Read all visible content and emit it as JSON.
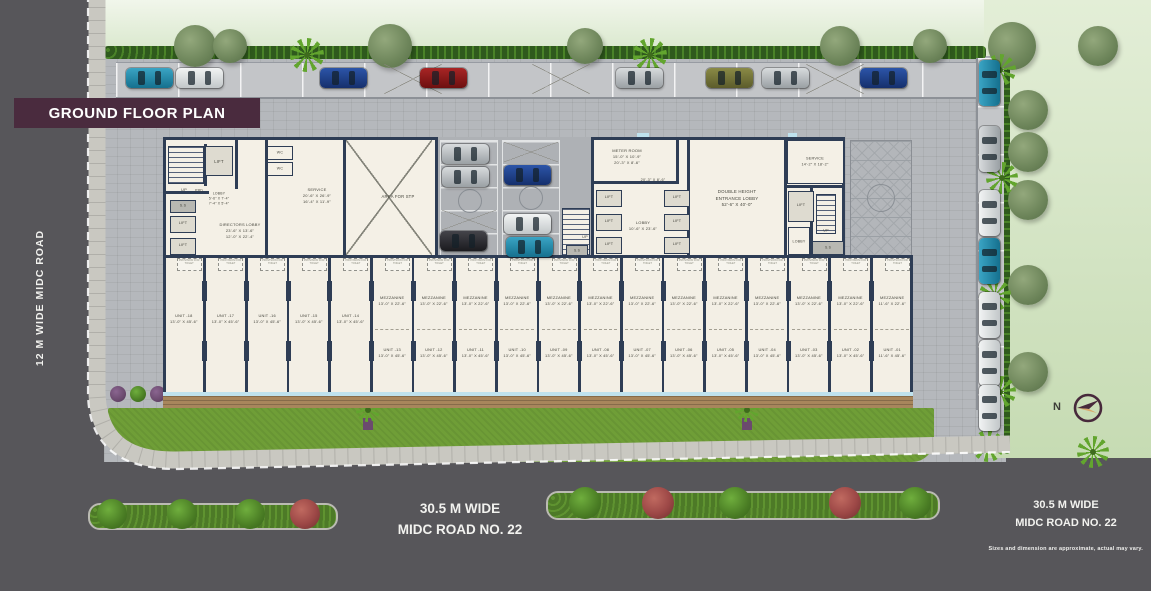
{
  "title": "GROUND FLOOR PLAN",
  "roads": {
    "left": "12 M WIDE MIDC ROAD",
    "bottom_line1": "30.5 M WIDE",
    "bottom_line2": "MIDC ROAD NO. 22",
    "right_line1": "30.5 M WIDE",
    "right_line2": "MIDC ROAD NO. 22"
  },
  "disclaimer": "Sizes and dimension are approximate, actual may vary.",
  "compass": {
    "north_label": "N"
  },
  "plan": {
    "rooms": {
      "up1": [
        "UP"
      ],
      "lift_tl": [
        "LIFT"
      ],
      "prd": [
        "PRD"
      ],
      "lobby_tl": [
        "LOBBY",
        "5'-6\" X 7'-4\"",
        "7'-4\" X 5'-4\""
      ],
      "ss1": [
        "S.S"
      ],
      "lift_l1": [
        "LIFT"
      ],
      "lift_l2": [
        "LIFT"
      ],
      "directors": [
        "DIRECTORS LOBBY",
        "23'-6\" X 13'-6\"",
        "12'-0\" X 22'-4\""
      ],
      "wc1": [
        "WC"
      ],
      "wc2": [
        "WC"
      ],
      "service_l": [
        "SERVICE",
        "20'-6\" X 26'-9\"",
        "16'-4\" X 11'-9\""
      ],
      "stp": [
        "AREA FOR STP"
      ],
      "up2": [
        "UP"
      ],
      "ss2": [
        "S.S"
      ],
      "meter": [
        "METER ROOM",
        "15'-0\" X 10'-9\"",
        "20'-3\" X 8'-6\""
      ],
      "corridor_dim": [
        "20'-3\" X 8'-6\""
      ],
      "lift1": [
        "LIFT"
      ],
      "lift2": [
        "LIFT"
      ],
      "lift3": [
        "LIFT"
      ],
      "lift4": [
        "LIFT"
      ],
      "lift5": [
        "LIFT"
      ],
      "lift6": [
        "LIFT"
      ],
      "lobby_m": [
        "LOBBY",
        "10'-6\" X 23'-6\""
      ],
      "dh": [
        "DOUBLE HEIGHT",
        "ENTRANCE LOBBY",
        "52'-6\" X 40'-0\""
      ],
      "service_r": [
        "SERVICE",
        "14'-2\" X 18'-2\""
      ],
      "lift_r": [
        "LIFT"
      ],
      "up3": [
        "UP"
      ],
      "lobby_r": [
        "LOBBY"
      ],
      "ss3": [
        "S.S"
      ]
    },
    "mezzanine_label": "MEZZANINE",
    "provision_label": "PROVISION FOR TOILET",
    "units": [
      {
        "no": "UNIT -18",
        "dim": "13'-0\" X 45'-6\""
      },
      {
        "no": "UNIT -17",
        "dim": "13'-0\" X 45'-6\""
      },
      {
        "no": "UNIT -16",
        "dim": "13'-0\" X 45'-6\""
      },
      {
        "no": "UNIT -15",
        "dim": "13'-0\" X 45'-6\""
      },
      {
        "no": "UNIT -14",
        "dim": "13'-0\" X 45'-6\""
      },
      {
        "no": "UNIT -13",
        "dim": "13'-0\" X 45'-6\"",
        "mezz_dim": "13'-0\" X 22'-6\""
      },
      {
        "no": "UNIT -12",
        "dim": "13'-0\" X 45'-6\"",
        "mezz_dim": "13'-0\" X 22'-6\""
      },
      {
        "no": "UNIT -11",
        "dim": "13'-0\" X 45'-6\"",
        "mezz_dim": "13'-0\" X 22'-6\""
      },
      {
        "no": "UNIT -10",
        "dim": "13'-0\" X 45'-6\"",
        "mezz_dim": "13'-0\" X 22'-6\""
      },
      {
        "no": "UNIT -09",
        "dim": "13'-0\" X 45'-6\"",
        "mezz_dim": "13'-0\" X 22'-6\""
      },
      {
        "no": "UNIT -08",
        "dim": "13'-0\" X 45'-6\"",
        "mezz_dim": "13'-0\" X 22'-6\""
      },
      {
        "no": "UNIT -07",
        "dim": "13'-0\" X 45'-6\"",
        "mezz_dim": "13'-0\" X 22'-6\""
      },
      {
        "no": "UNIT -06",
        "dim": "13'-0\" X 45'-6\"",
        "mezz_dim": "13'-0\" X 22'-6\""
      },
      {
        "no": "UNIT -05",
        "dim": "13'-0\" X 45'-6\"",
        "mezz_dim": "13'-0\" X 22'-6\""
      },
      {
        "no": "UNIT -04",
        "dim": "13'-0\" X 45'-6\"",
        "mezz_dim": "13'-0\" X 22'-6\""
      },
      {
        "no": "UNIT -03",
        "dim": "13'-0\" X 45'-6\"",
        "mezz_dim": "13'-0\" X 22'-6\""
      },
      {
        "no": "UNIT -02",
        "dim": "13'-0\" X 45'-6\"",
        "mezz_dim": "13'-0\" X 22'-6\""
      },
      {
        "no": "UNIT -01",
        "dim": "11'-6\" X 45'-6\"",
        "mezz_dim": "11'-6\" X 22'-6\""
      }
    ]
  },
  "scene": {
    "colors": {
      "title_bg": "#4a2b3e",
      "wall": "#2e3d55",
      "road": "#57565a",
      "lawn": "#6f9e37",
      "room_fill": "#f4f0e6",
      "glass": "#bfe2ee"
    },
    "top_cars": [
      {
        "x": 126,
        "c": "teal"
      },
      {
        "x": 176,
        "c": "white"
      },
      {
        "x": 320,
        "c": "navy"
      },
      {
        "x": 420,
        "c": "red"
      },
      {
        "x": 616,
        "c": "silver"
      },
      {
        "x": 706,
        "c": "olive"
      },
      {
        "x": 762,
        "c": "silver"
      },
      {
        "x": 860,
        "c": "navy"
      }
    ],
    "bay_cars": [
      {
        "x": 442,
        "y": 144,
        "c": "silver"
      },
      {
        "x": 442,
        "y": 167,
        "c": "silver"
      },
      {
        "x": 440,
        "y": 231,
        "c": "black"
      },
      {
        "x": 504,
        "y": 165,
        "c": "navy"
      },
      {
        "x": 504,
        "y": 214,
        "c": "white"
      },
      {
        "x": 506,
        "y": 237,
        "c": "teal"
      }
    ],
    "right_cars": [
      {
        "y": 60,
        "c": "teal"
      },
      {
        "y": 126,
        "c": "silver"
      },
      {
        "y": 190,
        "c": "white"
      },
      {
        "y": 238,
        "c": "teal"
      },
      {
        "y": 292,
        "c": "white"
      },
      {
        "y": 340,
        "c": "white"
      },
      {
        "y": 385,
        "c": "white"
      }
    ],
    "top_trees": [
      {
        "x": 195,
        "r": 21
      },
      {
        "x": 230,
        "r": 17
      },
      {
        "x": 390,
        "r": 22
      },
      {
        "x": 585,
        "r": 18
      },
      {
        "x": 840,
        "r": 20
      },
      {
        "x": 930,
        "r": 17
      },
      {
        "x": 1012,
        "r": 24
      },
      {
        "x": 1098,
        "r": 20
      }
    ],
    "top_palms": [
      {
        "x": 307
      },
      {
        "x": 650
      }
    ],
    "right_trees": [
      {
        "y": 110
      },
      {
        "y": 152
      },
      {
        "y": 200
      },
      {
        "y": 285
      },
      {
        "y": 372
      }
    ],
    "right_palms": [
      {
        "x": 1000,
        "y": 70
      },
      {
        "x": 1002,
        "y": 178
      },
      {
        "x": 995,
        "y": 295
      },
      {
        "x": 1000,
        "y": 392
      },
      {
        "x": 988,
        "y": 446
      },
      {
        "x": 1093,
        "y": 452
      }
    ],
    "lawn_palms": [
      {
        "x": 368
      },
      {
        "x": 747
      }
    ],
    "lawn_shrubs": [
      {
        "x": 118,
        "c": "purple"
      },
      {
        "x": 138,
        "c": "green"
      },
      {
        "x": 158,
        "c": "purple"
      },
      {
        "x": 178,
        "c": "green"
      },
      {
        "x": 200,
        "c": "purple"
      },
      {
        "x": 222,
        "c": "green"
      }
    ],
    "median1_shrubs": [
      {
        "x": 112,
        "c": "green"
      },
      {
        "x": 182,
        "c": "green"
      },
      {
        "x": 250,
        "c": "green"
      },
      {
        "x": 305,
        "c": "red"
      }
    ],
    "median2_shrubs": [
      {
        "x": 585,
        "c": "green"
      },
      {
        "x": 658,
        "c": "red"
      },
      {
        "x": 735,
        "c": "green"
      },
      {
        "x": 845,
        "c": "red"
      },
      {
        "x": 915,
        "c": "green"
      }
    ],
    "empty_stalls_x": [
      384,
      532,
      806
    ]
  }
}
